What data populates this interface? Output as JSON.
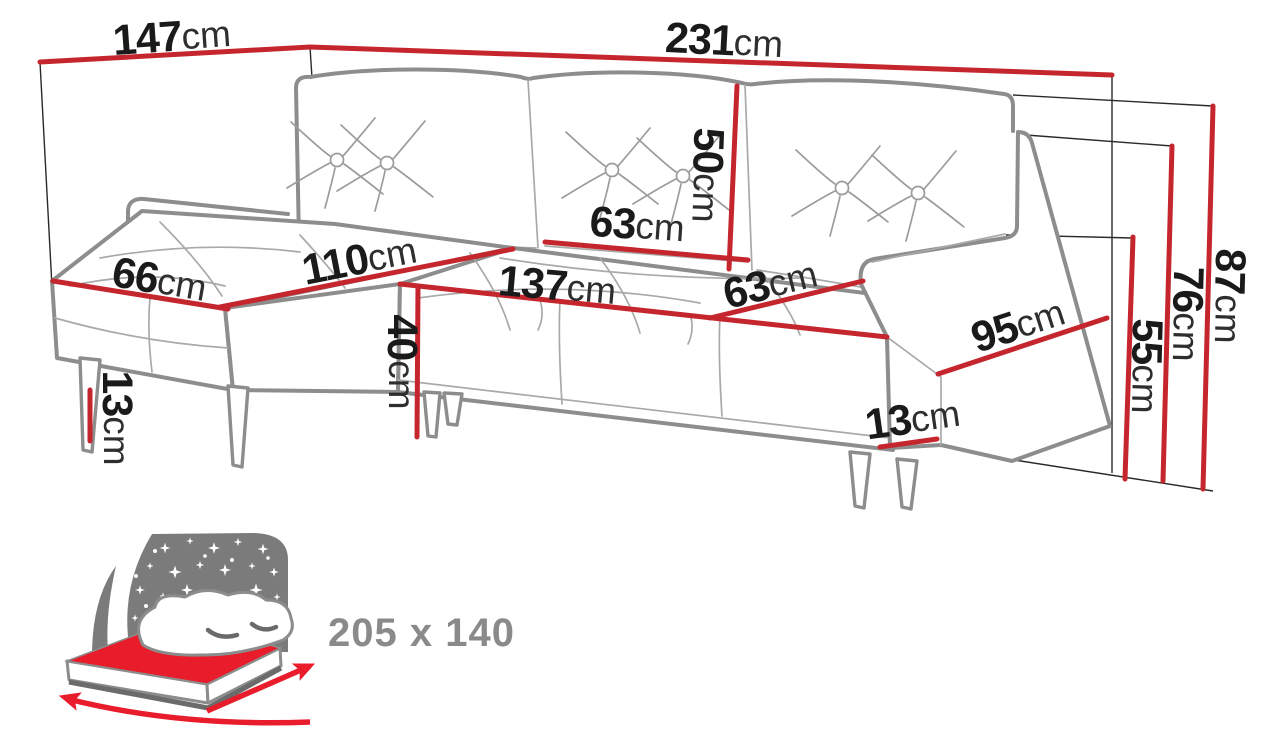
{
  "colors": {
    "dimension_red": "#c5262d",
    "sofa_outline_gray": "#8d8d8d",
    "label_black": "#1a1a1a",
    "bed_icon_gray": "#7b7b7b",
    "bed_mattress_red": "#e81c2a",
    "bed_size_gray": "#8a8a8a"
  },
  "dimensions": {
    "back_width_left": {
      "value": "147",
      "unit": "cm"
    },
    "back_width_right": {
      "value": "231",
      "unit": "cm"
    },
    "back_cushion_height": {
      "value": "50",
      "unit": "cm"
    },
    "back_cushion_width": {
      "value": "63",
      "unit": "cm"
    },
    "chaise_length": {
      "value": "110",
      "unit": "cm"
    },
    "chaise_width": {
      "value": "66",
      "unit": "cm"
    },
    "seat_front_width": {
      "value": "137",
      "unit": "cm"
    },
    "seat_depth": {
      "value": "63",
      "unit": "cm"
    },
    "armrest_length": {
      "value": "95",
      "unit": "cm"
    },
    "seat_height": {
      "value": "40",
      "unit": "cm"
    },
    "front_leg_height": {
      "value": "13",
      "unit": "cm"
    },
    "side_leg_height": {
      "value": "13",
      "unit": "cm"
    },
    "armrest_height": {
      "value": "55",
      "unit": "cm"
    },
    "backrest_height": {
      "value": "76",
      "unit": "cm"
    },
    "total_height": {
      "value": "87",
      "unit": "cm"
    }
  },
  "sleeping_area": {
    "size_label": "205 x 140",
    "icon": "bed-with-starry-headboard"
  }
}
